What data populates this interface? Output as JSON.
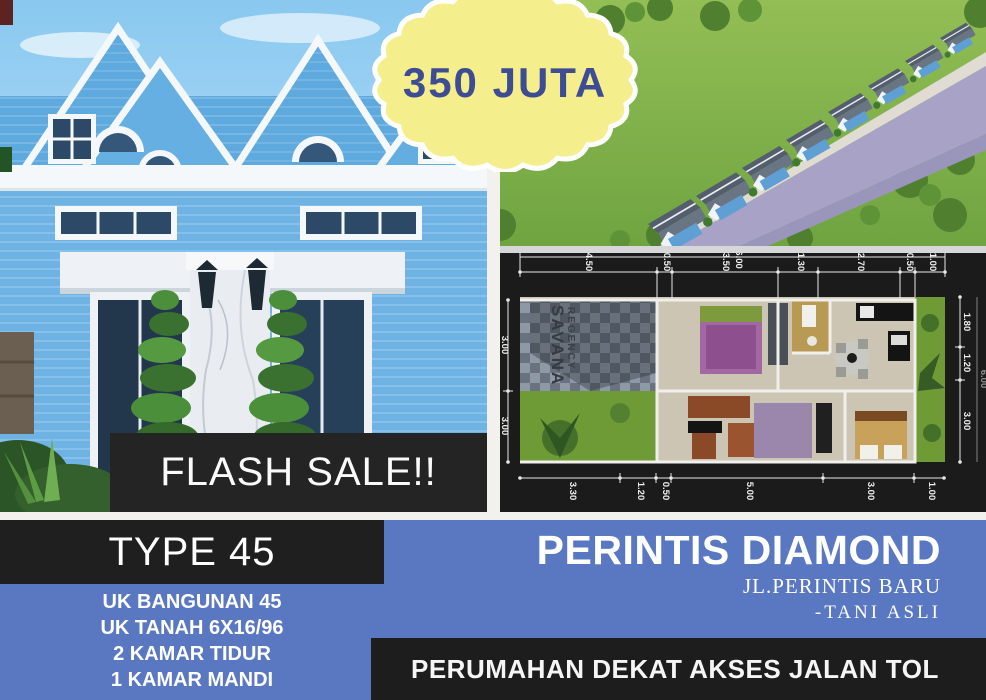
{
  "poster": {
    "price_badge": {
      "text": "350 JUTA"
    },
    "flash_sale": {
      "text": "FLASH SALE!!"
    },
    "left_panel": {
      "type_title": "TYPE 45",
      "details": [
        "UK BANGUNAN 45",
        "UK TANAH 6X16/96",
        "2 KAMAR TIDUR",
        "1 KAMAR MANDI"
      ]
    },
    "right_panel": {
      "title": "PERINTIS DIAMOND",
      "address_line1": "JL.PERINTIS BARU",
      "address_line2": "-TANI ASLI",
      "banner": "PERUMAHAN DEKAT AKSES JALAN TOL"
    },
    "floor_plan": {
      "watermark_line1": "SAVANA",
      "watermark_line2": "REGENCY",
      "dims_top_overall": "16.00",
      "dims_top": [
        "4.50",
        "0.50",
        "3.50",
        "1.30",
        "2.70",
        "0.50",
        "1.00"
      ],
      "dims_bottom": [
        "3.30",
        "1.20",
        "0.50",
        "5.00",
        "3.00",
        "1.00"
      ],
      "dims_left": [
        "3.00",
        "3.00"
      ],
      "dims_right": [
        "1.80",
        "1.20",
        "3.00"
      ],
      "dims_right_overall": "6.00"
    },
    "colors": {
      "bottom_blue": "#5a78c2",
      "badge_yellow": "#f5ee8d",
      "badge_text_navy": "#3e4c94",
      "panel_black": "#1f1f1f",
      "house_blue": "#5ea9de"
    }
  }
}
